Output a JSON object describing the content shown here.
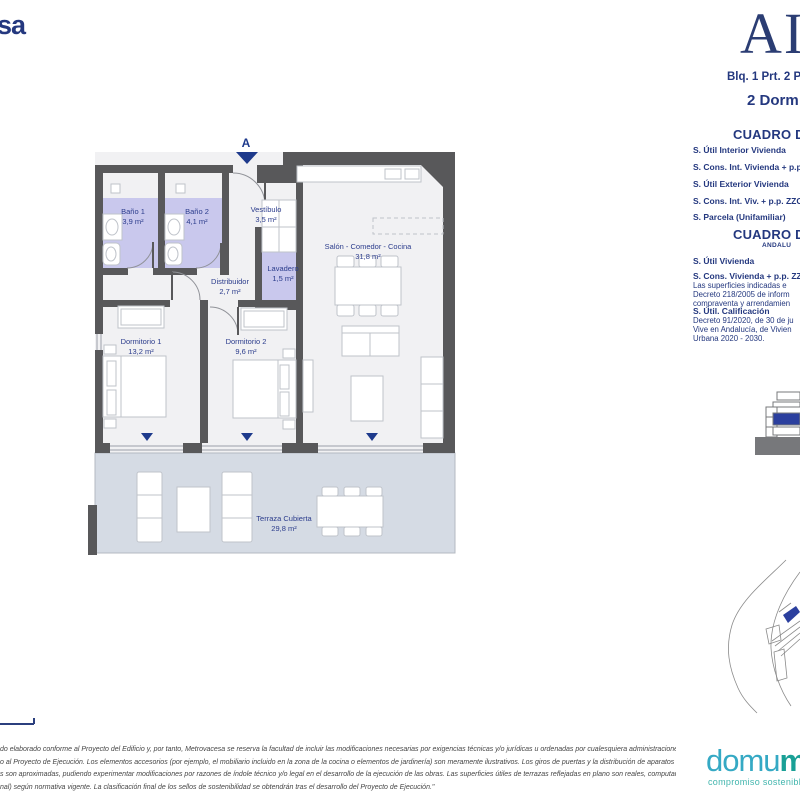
{
  "header": {
    "brand_partial": "sa",
    "project_wordmark_partial": "AIR",
    "unit_reference": "Blq. 1 Prt. 2 P",
    "unit_type": "2 Dorm"
  },
  "plan": {
    "section_marker": "A",
    "rooms": {
      "bano1": {
        "name": "Baño 1",
        "area": "3,9 m²"
      },
      "bano2": {
        "name": "Baño 2",
        "area": "4,1 m²"
      },
      "vestibulo": {
        "name": "Vestíbulo",
        "area": "3,5 m²"
      },
      "lavadero": {
        "name": "Lavadero",
        "area": "1,5 m²"
      },
      "distribuidor": {
        "name": "Distribuidor",
        "area": "2,7 m²"
      },
      "salon": {
        "name": "Salón - Comedor - Cocina",
        "area": "31,8 m²"
      },
      "dormitorio1": {
        "name": "Dormitorio 1",
        "area": "13,2 m²"
      },
      "dormitorio2": {
        "name": "Dormitorio 2",
        "area": "9,6 m²"
      },
      "terraza": {
        "name": "Terraza Cubierta",
        "area": "29,8 m²"
      }
    }
  },
  "surfaces_table_1": {
    "title": "CUADRO DE",
    "rows": [
      "S. Útil Interior Vivienda",
      "S. Cons. Int. Vivienda + p.p.",
      "S. Útil Exterior Vivienda",
      "S. Cons. Int. Viv. + p.p. ZZC",
      "S. Parcela (Unifamiliar)"
    ]
  },
  "surfaces_table_2": {
    "title": "CUADRO DE",
    "subtitle": "ANDALU",
    "row_util": "S. Útil Vivienda",
    "row_cons": "S. Cons. Vivienda + p.p. ZZ",
    "note_decreto218": [
      "Las superficies indicadas e",
      "Decreto 218/2005 de inform",
      "compraventa y arrendamien"
    ],
    "row_calificacion": "S. Útil. Calificación",
    "note_decreto91": [
      "Decreto 91/2020, de 30 de ju",
      "Vive en Andalucía, de Vivien",
      "Urbana 2020 - 2030."
    ]
  },
  "footer": {
    "disclaimer_lines": [
      "do elaborado conforme al Proyecto del Edificio y, por tanto, Metrovacesa se reserva la facultad de incluir las modificaciones necesarias por exigencias técnicas y/o jurídicas u ordenadas por cualesquiera administraciones u",
      "o al Proyecto de Ejecución. Los elementos accesorios (por ejemplo, el mobiliario incluido en la zona de la cocina o elementos de jardinería) son meramente ilustrativos. Los giros de puertas y la distribución de aparatos sanitarios",
      "s son aproximadas, pudiendo experimentar modificaciones por razones de índole técnico y/o legal en el desarrollo de la ejecución de las obras. Las superficies útiles de terrazas reflejadas en plano son reales, computan en la",
      "nal) según normativa vigente. La clasificación final de los sellos de sostenibilidad se obtendrán tras el desarrollo del Proyecto de Ejecución.\""
    ],
    "domum_light": "domu",
    "domum_bold": "m",
    "domum_tagline": "compromiso sostenible"
  },
  "colors": {
    "navy": "#24387f",
    "wall_gray": "#58585a",
    "room_purple": "#c9c8ed",
    "terrace_gray": "#d5dbe4",
    "marker_blue": "#1e3a8c",
    "teal_light": "#35a9c4",
    "teal_dark": "#1aa096"
  }
}
